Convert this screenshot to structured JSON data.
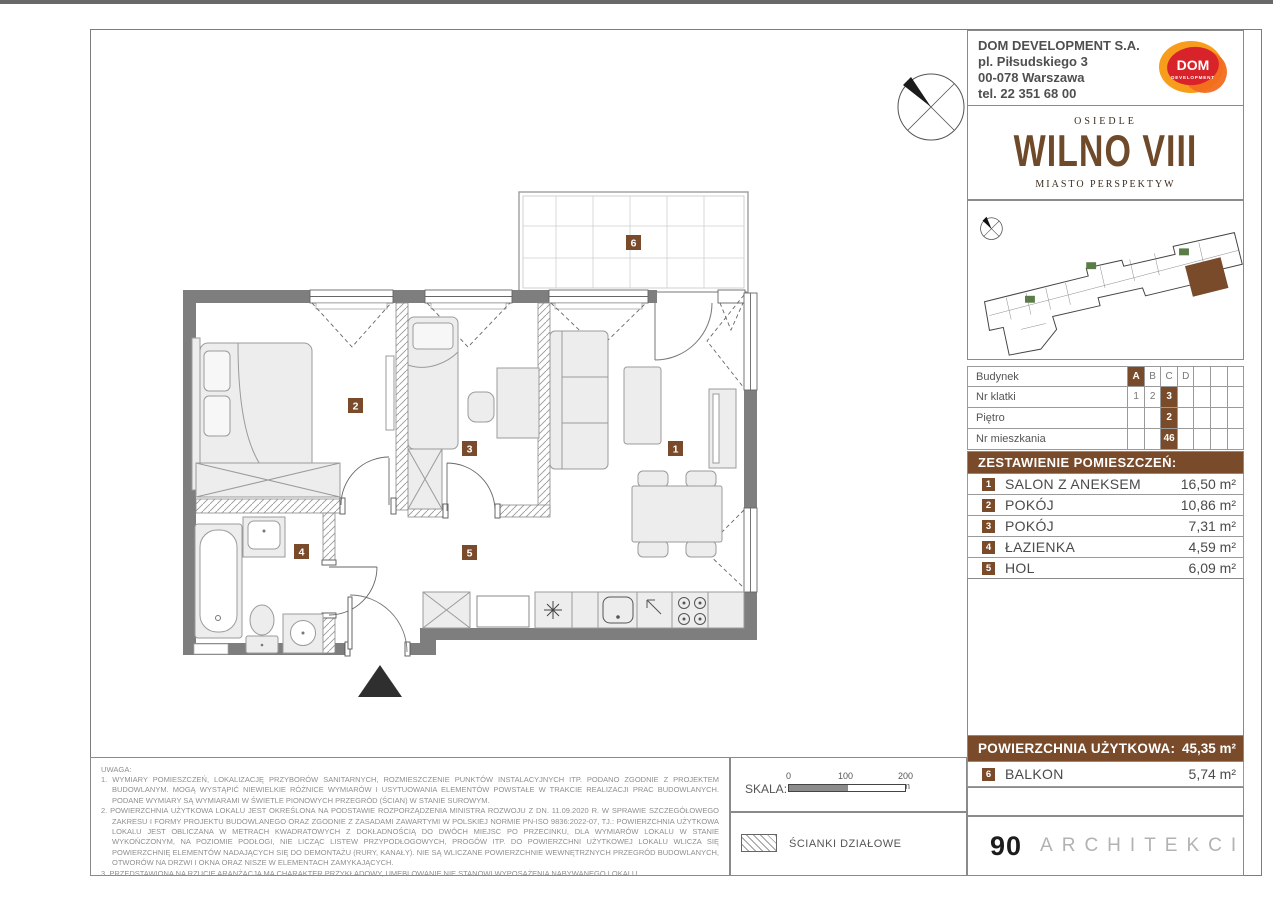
{
  "colors": {
    "brown": "#7a4b2a",
    "wall": "#7e7e7e",
    "logo_red": "#d8232a",
    "logo_orange": "#f89c1c"
  },
  "company": {
    "name": "DOM DEVELOPMENT S.A.",
    "address1": "pl. Piłsudskiego 3",
    "address2": "00-078 Warszawa",
    "phone": "tel. 22 351 68 00",
    "logo_text": "DOM",
    "logo_sub": "DEVELOPMENT"
  },
  "brand": {
    "osiedle": "OSIEDLE",
    "name": "WILNO VIII",
    "tagline": "MIASTO PERSPEKTYW"
  },
  "unit_table": {
    "rows": [
      {
        "label": "Budynek",
        "cells": [
          "A",
          "B",
          "C",
          "D",
          "",
          "",
          ""
        ]
      },
      {
        "label": "Nr klatki",
        "cells": [
          "1",
          "2",
          "3",
          "",
          "",
          "",
          ""
        ]
      },
      {
        "label": "Piętro",
        "cells": [
          "",
          "",
          "2",
          "",
          "",
          "",
          ""
        ]
      },
      {
        "label": "Nr mieszkania",
        "cells": [
          "",
          "",
          "46",
          "",
          "",
          "",
          ""
        ]
      }
    ]
  },
  "rooms_header": "ZESTAWIENIE POMIESZCZEŃ:",
  "rooms": [
    {
      "no": "1",
      "name": "SALON Z ANEKSEM",
      "area": "16,50 m²"
    },
    {
      "no": "2",
      "name": "POKÓJ",
      "area": "10,86 m²"
    },
    {
      "no": "3",
      "name": "POKÓJ",
      "area": "7,31 m²"
    },
    {
      "no": "4",
      "name": "ŁAZIENKA",
      "area": "4,59 m²"
    },
    {
      "no": "5",
      "name": "HOL",
      "area": "6,09 m²"
    }
  ],
  "total": {
    "label": "POWIERZCHNIA UŻYTKOWA:",
    "value": "45,35 m²"
  },
  "balcony_row": {
    "no": "6",
    "name": "BALKON",
    "area": "5,74 m²"
  },
  "plan": {
    "badges": {
      "b1": "1",
      "b2": "2",
      "b3": "3",
      "b4": "4",
      "b5": "5",
      "b6": "6"
    }
  },
  "scale": {
    "label": "SKALA:",
    "ticks": [
      "0",
      "100",
      "200 cm"
    ]
  },
  "legend": {
    "partition_label": "ŚCIANKI DZIAŁOWE"
  },
  "architect": {
    "number": "90",
    "name": "ARCHITEKCI"
  },
  "notes": {
    "title": "UWAGA:",
    "items": [
      "1. WYMIARY POMIESZCZEŃ, LOKALIZACJĘ PRZYBORÓW SANITARNYCH, ROZMIESZCZENIE PUNKTÓW INSTALACYJNYCH ITP. PODANO ZGODNIE Z PROJEKTEM BUDOWLANYM. MOGĄ WYSTĄPIĆ NIEWIELKIE RÓŻNICE WYMIARÓW I USYTUOWANIA ELEMENTÓW POWSTAŁE W TRAKCIE REALIZACJI PRAC BUDOWLANYCH. PODANE WYMIARY SĄ WYMIARAMI W ŚWIETLE PIONOWYCH PRZEGRÓD (ŚCIAN) W STANIE SUROWYM.",
      "2. POWIERZCHNIA UŻYTKOWA LOKALU JEST OKREŚLONA NA PODSTAWIE ROZPORZĄDZENIA MINISTRA ROZWOJU Z DN. 11.09.2020 R. W SPRAWIE SZCZEGÓŁOWEGO ZAKRESU I FORMY PROJEKTU BUDOWLANEGO ORAZ ZGODNIE Z ZASADAMI ZAWARTYMI W POLSKIEJ NORMIE PN-ISO 9836:2022-07, TJ.: POWIERZCHNIA UŻYTKOWA LOKALU JEST OBLICZANA W METRACH KWADRATOWYCH Z DOKŁADNOŚCIĄ DO DWÓCH MIEJSC PO PRZECINKU, DLA WYMIARÓW LOKALU W STANIE WYKOŃCZONYM, NA POZIOMIE PODŁOGI, NIE LICZĄC LISTEW PRZYPODŁOGOWYCH, PROGÓW ITP. DO POWIERZCHNI UŻYTKOWEJ LOKALU WLICZA SIĘ POWIERZCHNIĘ ELEMENTÓW NADAJĄCYCH SIĘ DO DEMONTAŻU (RURY, KANAŁY). NIE SĄ WLICZANE POWIERZCHNIE WEWNĘTRZNYCH PRZEGRÓD BUDOWLANYCH, OTWORÓW NA DRZWI I OKNA ORAZ NISZE W ELEMENTACH ZAMYKAJĄCYCH.",
      "3. PRZEDSTAWIONA NA RZUCIE ARANŻACJA MA CHARAKTER PRZYKŁADOWY, UMEBLOWANIE NIE STANOWI WYPOSAŻENIA NABYWANEGO LOKALU."
    ]
  }
}
